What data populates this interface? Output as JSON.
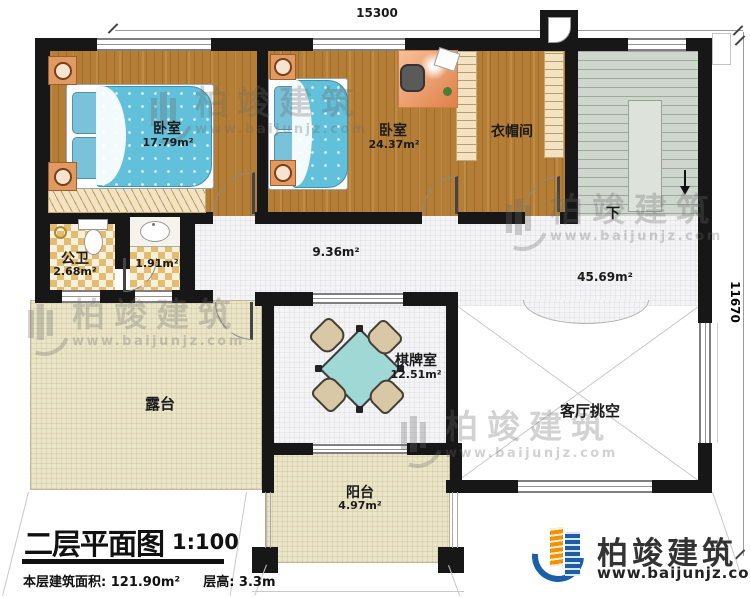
{
  "page": {
    "type": "architectural-floor-plan"
  },
  "dimensions": {
    "width_mm": "15300",
    "height_mm": "11670"
  },
  "rooms": {
    "bedroom1": {
      "name": "卧室",
      "area": "17.79m²"
    },
    "bedroom2": {
      "name": "卧室",
      "area": "24.37m²"
    },
    "cloakroom": {
      "name": "衣帽间"
    },
    "bathroom": {
      "name": "公卫",
      "area": "2.68m²"
    },
    "washroom": {
      "area": "1.91m²"
    },
    "hallway": {
      "area": "9.36m²"
    },
    "landing": {
      "area": "45.69m²"
    },
    "chess_room": {
      "name": "棋牌室",
      "area": "12.51m²"
    },
    "terrace": {
      "name": "露台"
    },
    "living_room_void": {
      "name": "客厅挑空"
    },
    "balcony": {
      "name": "阳台",
      "area": "4.97m²"
    },
    "stairs": {
      "direction_label": "下"
    }
  },
  "title_block": {
    "title": "二层平面图",
    "scale": "1:100",
    "area_info": "本层建筑面积: 121.90m²",
    "height_info": "层高: 3.3m"
  },
  "brand": {
    "name": "柏竣建筑",
    "website": "www.baijunjz.com",
    "logo_blue": "#1a5fa8",
    "logo_orange": "#f29200"
  },
  "watermark": {
    "name": "柏竣建筑",
    "website": "www.baijunjz.com"
  }
}
